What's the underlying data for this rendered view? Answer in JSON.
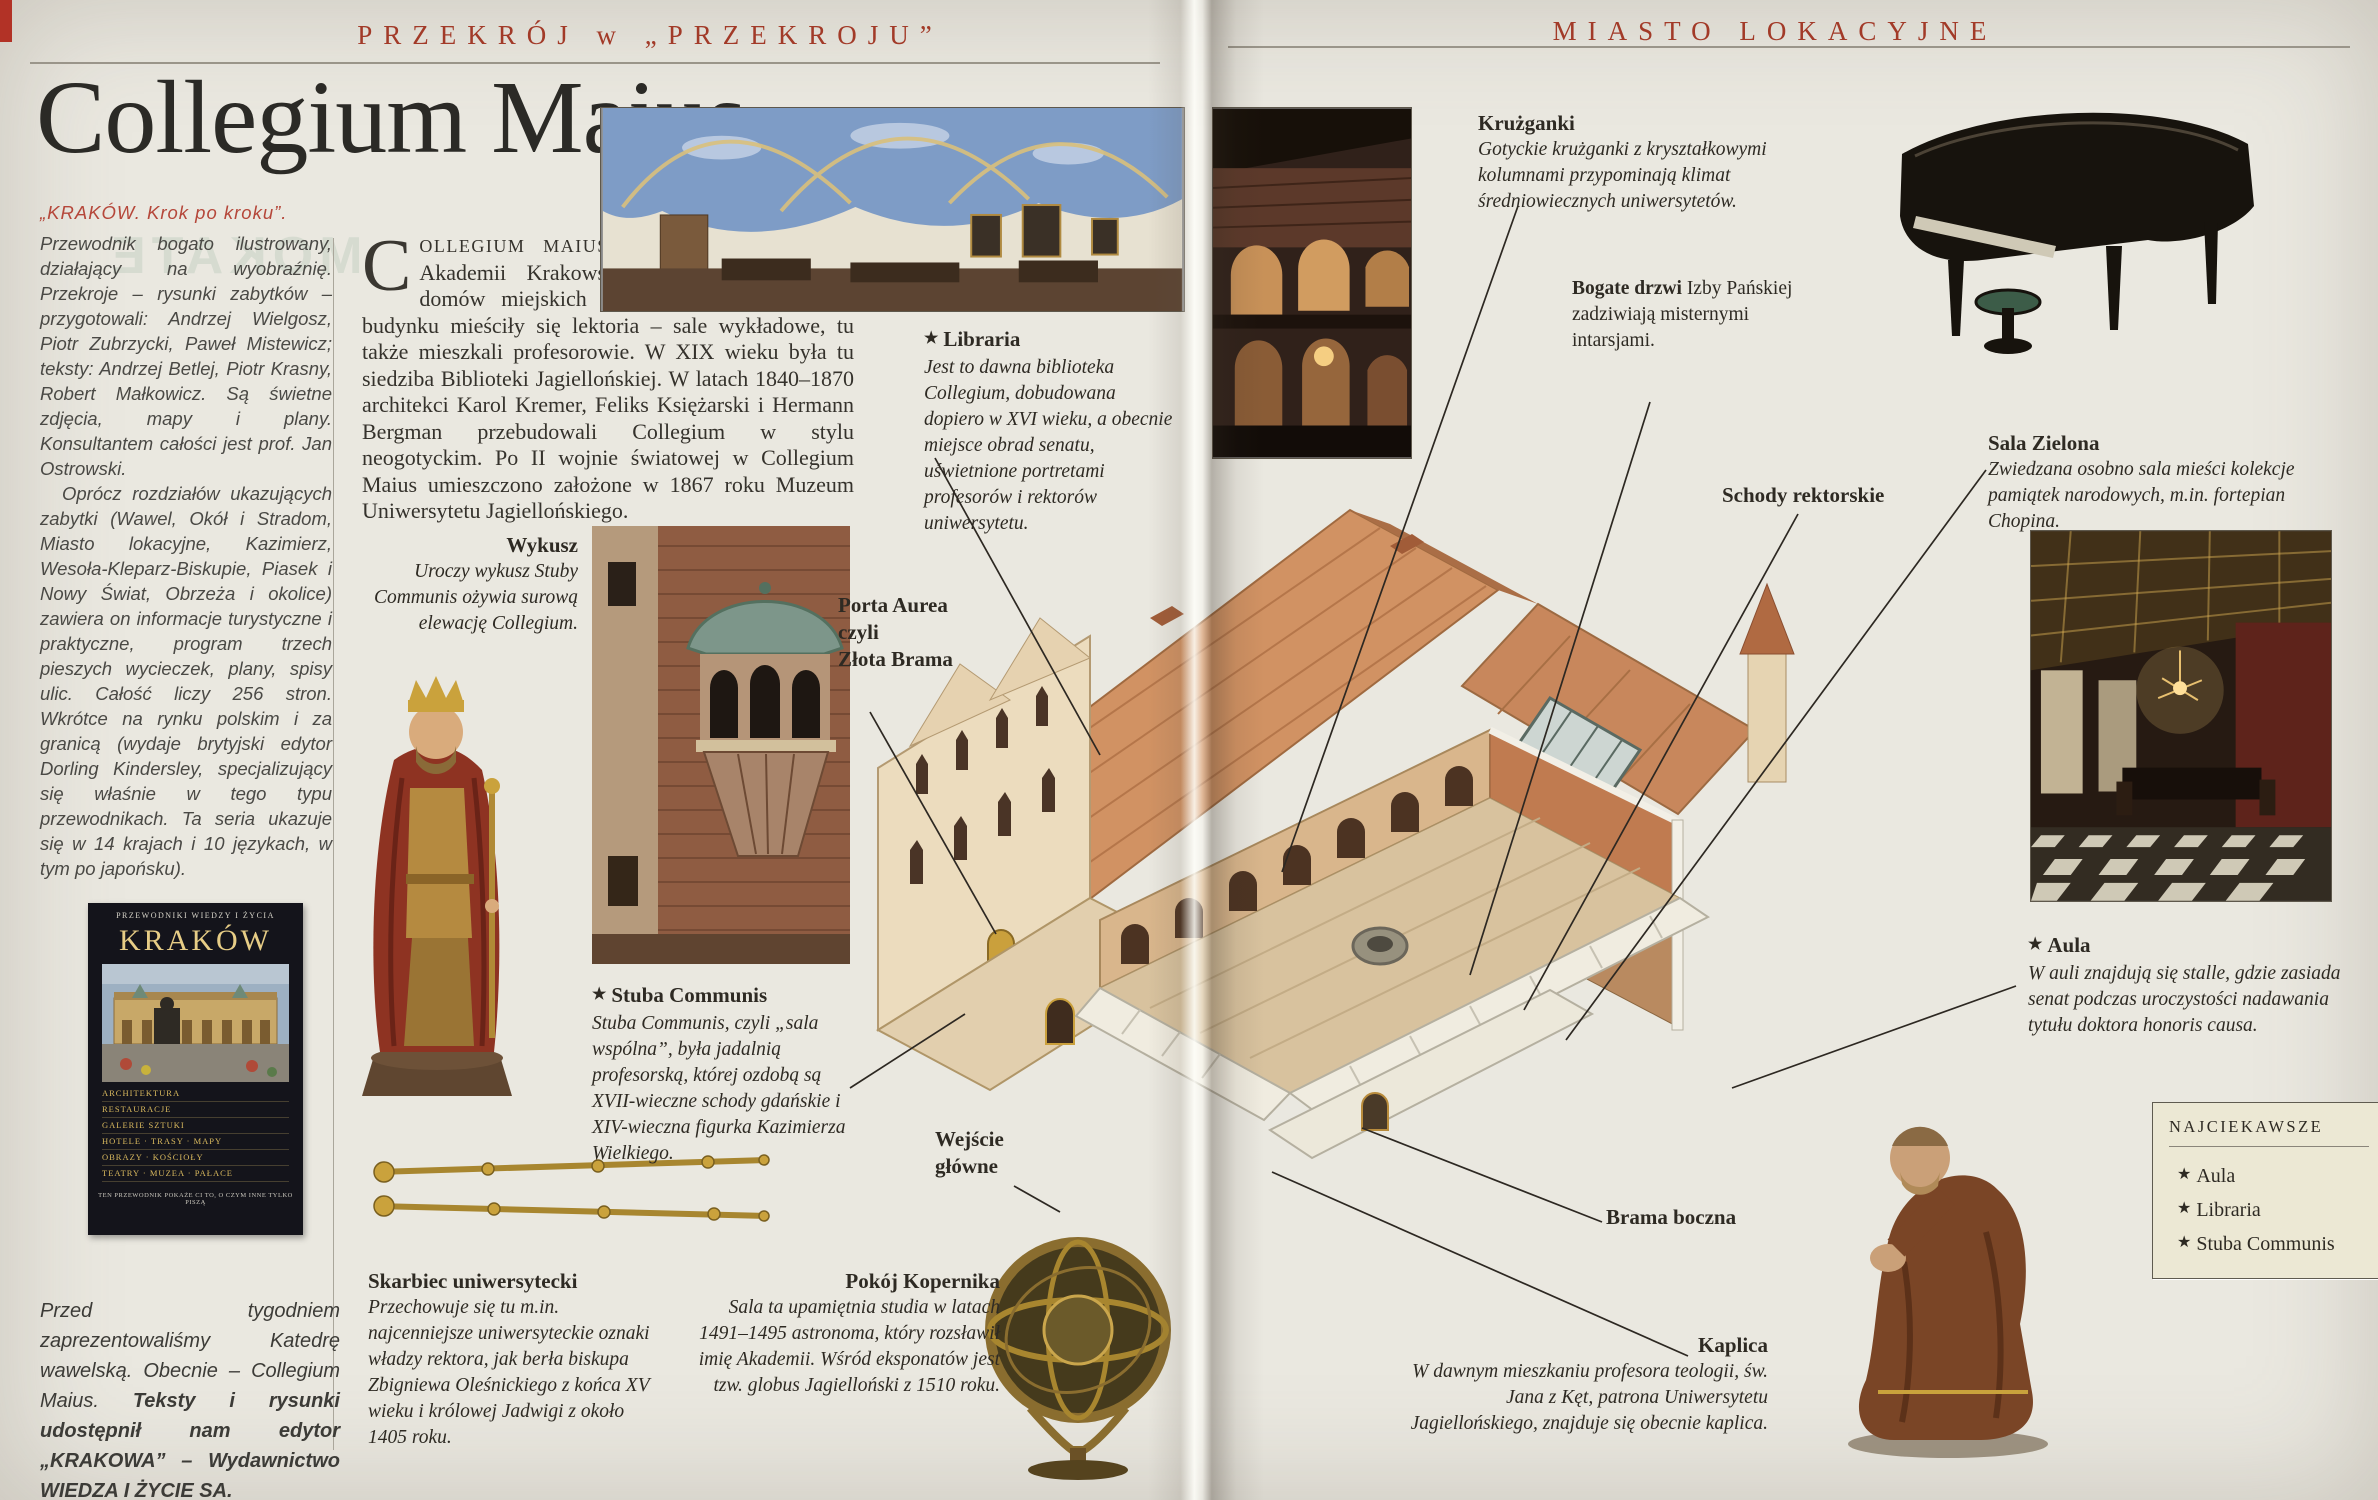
{
  "icons": {
    "star": "★"
  },
  "page": {
    "header_left": "PRZEKRÓJ w „PRZEKROJU”",
    "header_right": "MIASTO LOKACYJNE",
    "title": "Collegium Maius"
  },
  "ghost": {
    "text": "MOKATE"
  },
  "sidebar": {
    "lead": "„KRAKÓW. Krok po kroku”.",
    "para1": "Przewodnik bogato ilustrowany, działający na wyobraźnię. Przekroje – rysunki zabytków – przygotowali: Andrzej Wielgosz, Piotr Zubrzycki, Paweł Mistewicz; teksty: Andrzej Betlej, Piotr Krasny, Robert Małkowicz. Są świetne zdjęcia, mapy i plany. Konsultantem całości jest prof. Jan Ostrowski.",
    "para2": "Oprócz rozdziałów ukazujących zabytki (Wawel, Okół i Stradom, Miasto lokacyjne, Kazimierz, Wesoła-Kleparz-Biskupie, Piasek i Nowy Świat, Obrzeża i okolice) zawiera on informacje turystyczne i praktyczne, program trzech pieszych wycieczek, plany, spisy ulic. Całość liczy 256 stron. Wkrótce na rynku polskim i za granicą (wydaje brytyjski edytor Dorling Kindersley, specjalizujący się właśnie w tego typu przewodnikach. Ta seria ukazuje się w 14 krajach i 10 językach, w tym po japońsku).",
    "footer_normal": "Przed tygodniem zaprezentowaliśmy Katedrę wawelską. Obecnie – Collegium Maius. ",
    "footer_bold": "Teksty i rysunki udostępnił nam edytor „KRAKOWA” – Wydawnictwo WIEDZA I ŻYCIE SA."
  },
  "book": {
    "series": "PRZEWODNIKI WIEDZY I ŻYCIA",
    "title": "KRAKÓW",
    "rows": [
      "ARCHITEKTURA",
      "RESTAURACJE",
      "GALERIE SZTUKI",
      "HOTELE · TRASY · MAPY",
      "OBRAZY · KOŚCIOŁY",
      "TEATRY · MUZEA · PAŁACE"
    ],
    "footer": "TEN PRZEWODNIK POKAŻE CI TO, O CZYM INNE TYLKO PISZĄ"
  },
  "intro": {
    "dropcap": "C",
    "smallcaps": "OLLEGIUM MAIUS",
    "rest": " jest najstarszą budowlą Akademii Krakowskiej, utworzoną z kilku domów miejskich w ciągu XV stulecia. W budynku mieściły się lektoria – sale wykładowe, tu także mieszkali profesorowie. W XIX wieku była tu siedziba Biblioteki Jagiellońskiej. W latach 1840–1870 architekci Karol Kremer, Feliks Księżarski i Hermann Bergman przebudowali Collegium w stylu neogotyckim. Po II wojnie światowej w Collegium Maius umieszczono założone w 1867 roku Muzeum Uniwersytetu Jagiellońskiego."
  },
  "captions": {
    "wykusz": {
      "title": "Wykusz",
      "body": "Uroczy wykusz Stuby Communis ożywia surową elewację Collegium."
    },
    "libraria": {
      "title": "Libraria",
      "body": "Jest to dawna biblioteka Collegium, dobudowana dopiero w XVI wieku, a obecnie miejsce obrad senatu, uświetnione portretami profesorów i rektorów uniwersytetu."
    },
    "kruzganki": {
      "title": "Krużganki",
      "body": "Gotyckie krużganki z kryształkowymi kolumnami przypominają klimat średniowiecznych uniwersytetów."
    },
    "bogate_drzwi": {
      "title_bold": "Bogate drzwi",
      "title_rest": " Izby Pańskiej",
      "body": "zadziwiają misternymi intarsjami."
    },
    "sala_zielona": {
      "title": "Sala Zielona",
      "body": "Zwiedzana osobno sala mieści kolekcje pamiątek narodowych, m.in. fortepian Chopina."
    },
    "schody": {
      "title": "Schody rektorskie"
    },
    "porta": {
      "title": "Porta Aurea\nczyli\nZłota Brama"
    },
    "stuba": {
      "title": "Stuba Communis",
      "body": "Stuba Communis, czyli „sala wspólna”, była jadalnią profesorską, której ozdobą są XVII-wieczne schody gdańskie i XIV-wieczna figurka Kazimierza Wielkiego."
    },
    "aula": {
      "title": "Aula",
      "body": "W auli znajdują się stalle, gdzie zasiada senat podczas uroczystości nadawania tytułu doktora honoris causa."
    },
    "wejscie": {
      "title": "Wejście\ngłówne"
    },
    "skarbiec": {
      "title": "Skarbiec uniwersytecki",
      "body": "Przechowuje się tu m.in. najcenniejsze uniwersyteckie oznaki władzy rektora, jak berła biskupa Zbigniewa Oleśnickiego z końca XV wieku i królowej Jadwigi z około 1405 roku."
    },
    "kopernik": {
      "title": "Pokój Kopernika",
      "body": "Sala ta upamiętnia studia w latach 1491–1495 astronoma, który rozsławił imię Akademii. Wśród eksponatów jest tzw. globus Jagielloński z 1510 roku."
    },
    "brama": {
      "title": "Brama boczna"
    },
    "kaplica": {
      "title": "Kaplica",
      "body": "W dawnym mieszkaniu profesora teologii, św. Jana z Kęt, patrona Uniwersytetu Jagiellońskiego, znajduje się obecnie kaplica."
    }
  },
  "najciekawsze": {
    "title": "NAJCIEKAWSZE",
    "items": [
      "Aula",
      "Libraria",
      "Stuba Communis"
    ]
  },
  "colors": {
    "header_red": "#a23a28",
    "accent_red": "#b5473a",
    "page_bg": "#eae8e0",
    "roof": "#d09261",
    "wall_cream": "#ecdcbe",
    "box_bg": "#ece8d4"
  }
}
